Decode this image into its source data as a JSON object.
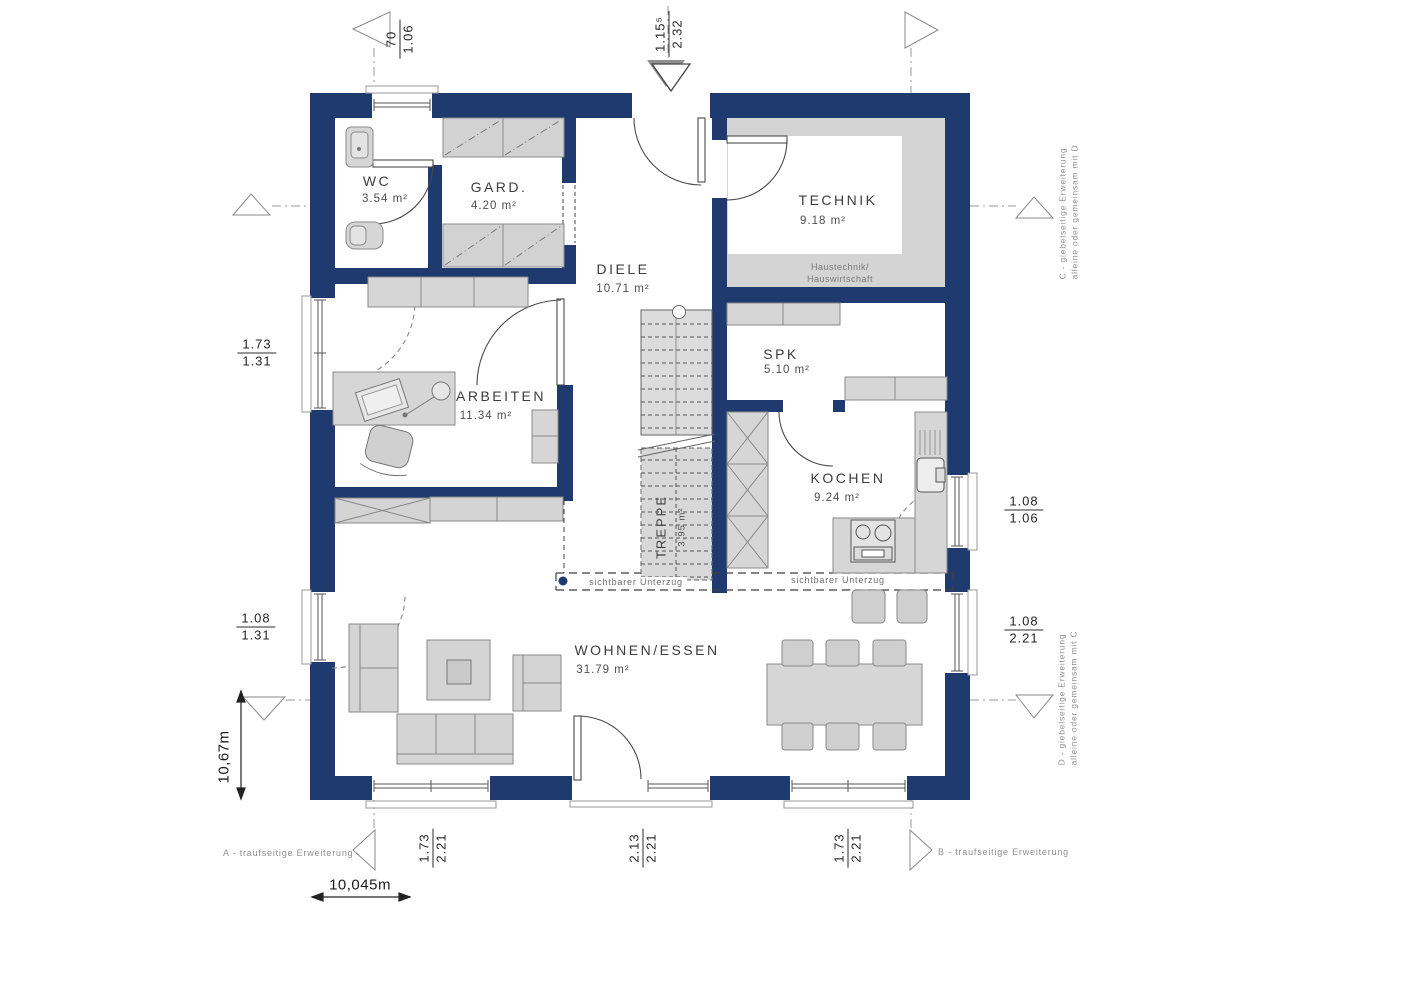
{
  "rooms": [
    {
      "id": "wc",
      "name": "WC",
      "area": "3.54 m²"
    },
    {
      "id": "gard",
      "name": "GARD.",
      "area": "4.20 m²"
    },
    {
      "id": "diele",
      "name": "DIELE",
      "area": "10.71 m²"
    },
    {
      "id": "technik",
      "name": "TECHNIK",
      "area": "9.18 m²",
      "note": "Haustechnik/\nHauswirtschaft"
    },
    {
      "id": "spk",
      "name": "SPK",
      "area": "5.10 m²"
    },
    {
      "id": "kochen",
      "name": "KOCHEN",
      "area": "9.24 m²"
    },
    {
      "id": "arbeiten",
      "name": "ARBEITEN",
      "area": "11.34 m²"
    },
    {
      "id": "wohnen_essen",
      "name": "WOHNEN/ESSEN",
      "area": "31.79 m²"
    },
    {
      "id": "treppe",
      "name": "TREPPE",
      "area": "3.95 m²"
    }
  ],
  "annotations": {
    "technik_note_line1": "Haustechnik/",
    "technik_note_line2": "Hauswirtschaft",
    "beam_left": "sichtbarer Unterzug",
    "beam_right": "sichtbarer Unterzug",
    "ext_a": "A - traufseitige Erweiterung",
    "ext_b": "B - traufseitige Erweiterung",
    "ext_c_line1": "C - giebelseitige Erweiterung",
    "ext_c_line2": "alleine oder gemeinsam mit D",
    "ext_d_line1": "D - giebelseitige Erweiterung",
    "ext_d_line2": "alleine oder gemeinsam mit C"
  },
  "dimensions": {
    "top_left": {
      "a": "70",
      "b": "1.06"
    },
    "top_entry": {
      "a": "1.15⁵",
      "b": "2.32"
    },
    "left_upper": {
      "a": "1.73",
      "b": "1.31"
    },
    "left_lower": {
      "a": "1.08",
      "b": "1.31"
    },
    "right_upper": {
      "a": "1.08",
      "b": "1.06"
    },
    "right_lower": {
      "a": "1.08",
      "b": "2.21"
    },
    "bottom_left": {
      "a": "1.73",
      "b": "2.21"
    },
    "bottom_center": {
      "a": "2.13",
      "b": "2.21"
    },
    "bottom_right": {
      "a": "1.73",
      "b": "2.21"
    },
    "total_width": "10,045m",
    "total_height": "10,67m"
  },
  "colors": {
    "wall": "#1f3a6e",
    "furniture_fill": "#d6d6d6",
    "furniture_stroke": "#8a8a8a",
    "technik_zone": "#d4d4d4",
    "stairs_fill": "#dcdcdc"
  }
}
